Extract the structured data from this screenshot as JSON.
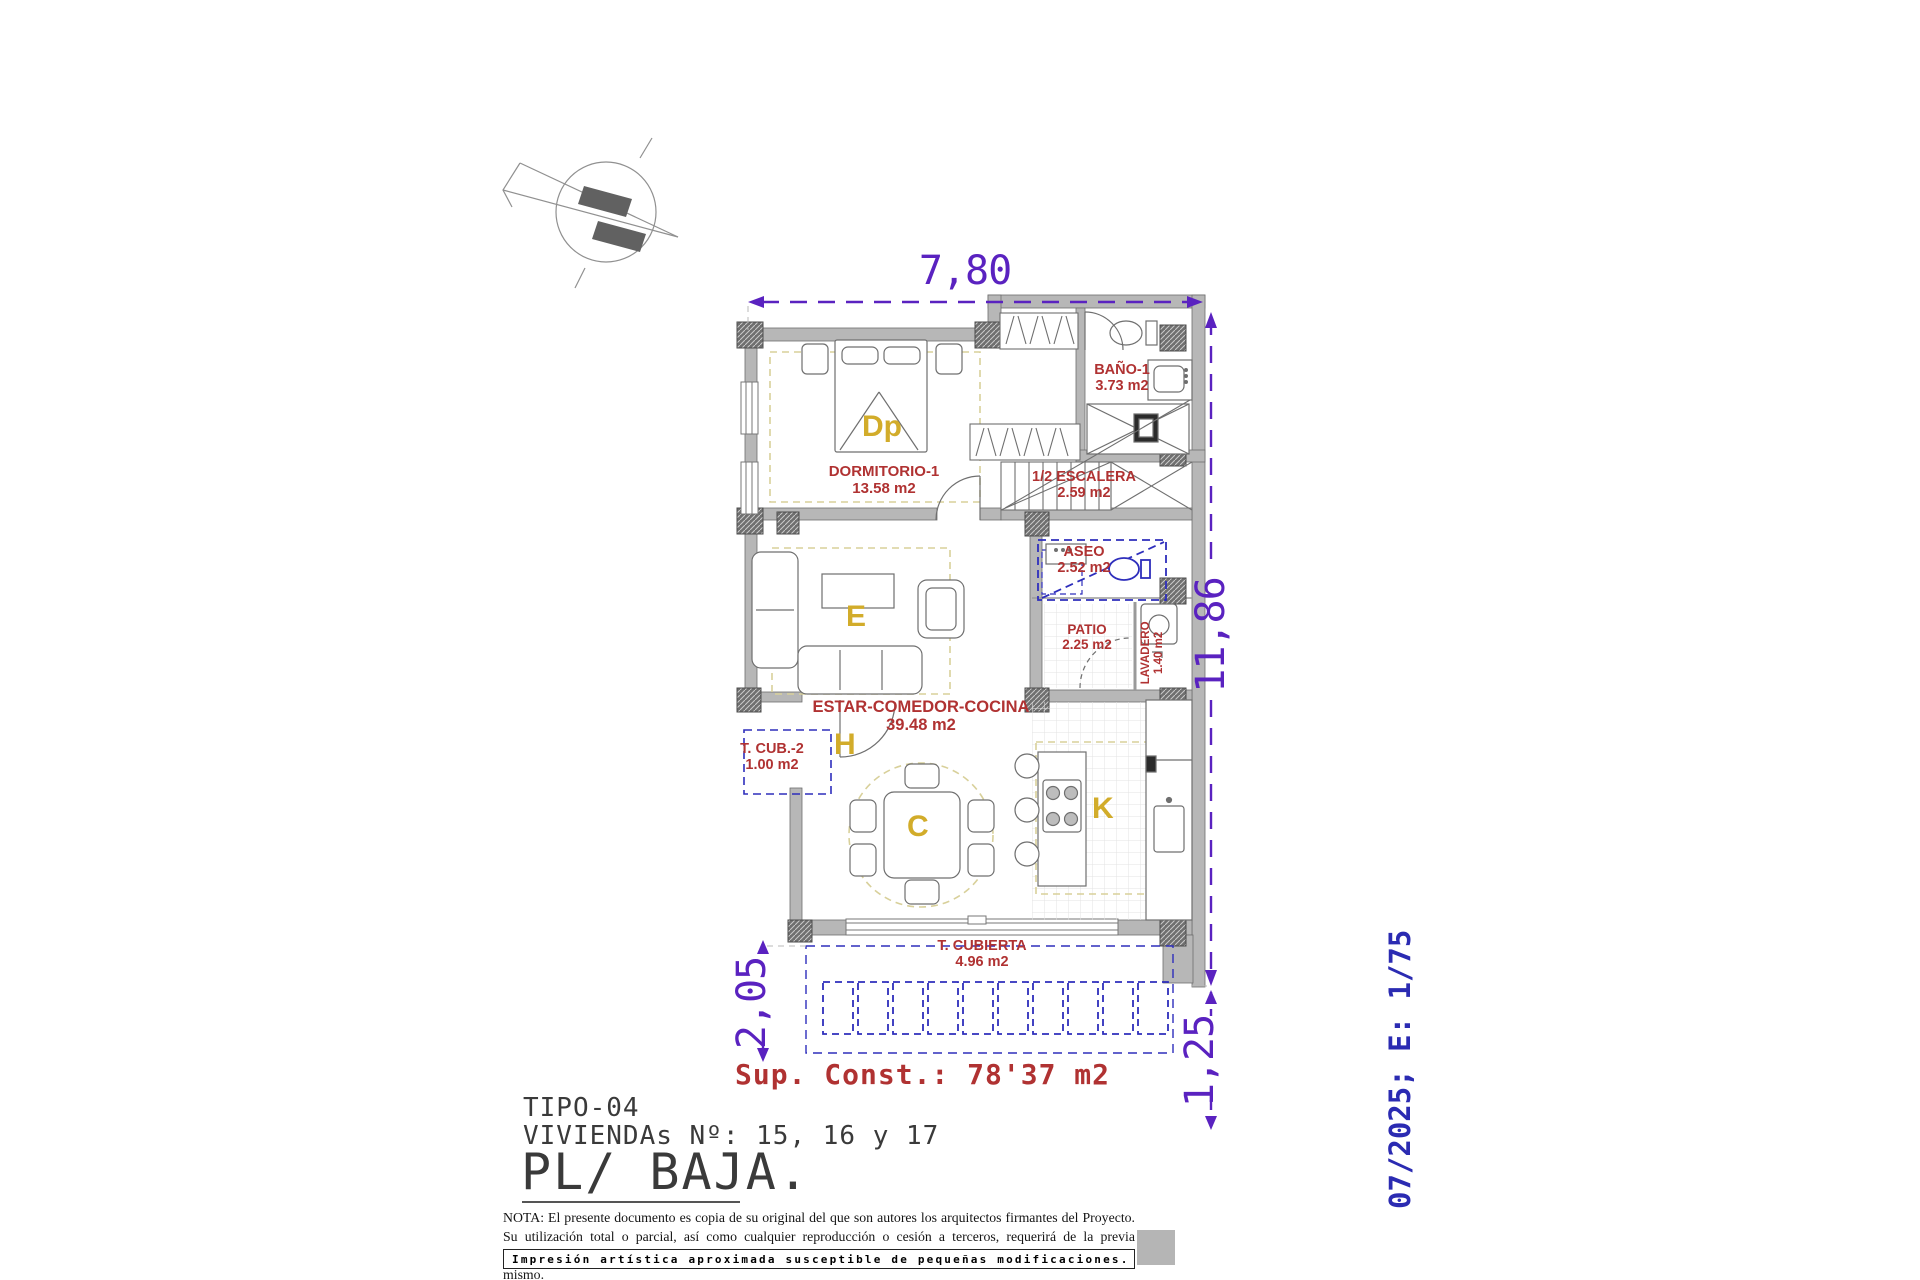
{
  "dimensions": {
    "top": "7,80",
    "right": "11,86",
    "bottom_left": "2,05",
    "bottom_right": "1,25"
  },
  "rooms": {
    "dormitorio": {
      "name": "DORMITORIO-1",
      "area": "13.58 m2",
      "letter": "Dp"
    },
    "bano": {
      "name": "BAÑO-1",
      "area": "3.73 m2"
    },
    "escalera": {
      "name": "1/2 ESCALERA",
      "area": "2.59 m2"
    },
    "aseo": {
      "name": "ASEO",
      "area": "2.52 m2"
    },
    "patio": {
      "name": "PATIO",
      "area": "2.25 m2"
    },
    "lavadero": {
      "name": "LAVADERO",
      "area": "1.40 m2"
    },
    "estar": {
      "name": "ESTAR-COMEDOR-COCINA",
      "area": "39.48 m2",
      "letter_estar": "E",
      "letter_hall": "H",
      "letter_comedor": "C",
      "letter_cocina": "K"
    },
    "tcub2": {
      "name": "T. CUB.-2",
      "area": "1.00 m2"
    },
    "tcubierta": {
      "name": "T. CUBIERTA",
      "area": "4.96 m2"
    }
  },
  "summary": {
    "sup_const": "Sup. Const.: 78'37 m2"
  },
  "title_block": {
    "tipo": "TIPO-04",
    "viviendas": "VIVIENDAs Nº: 15, 16 y 17",
    "planta": "PL/ BAJA."
  },
  "revision": {
    "date_scale": "07/2025; E: 1/75"
  },
  "legal": {
    "nota": "NOTA: El presente documento es copia de su original del que son autores los arquitectos firmantes del Proyecto. Su utilización total o parcial, así como cualquier reproducción o cesión a terceros, requerirá de la previa autorización expresa de sus autores, quedando en todo caso prohibida cualquier modificación unilateral del mismo.",
    "footer": "Impresión artística aproximada susceptible de pequeñas modificaciones."
  },
  "colors": {
    "dimension_purple": "#5a22c0",
    "room_label_red": "#b03232",
    "room_letter_yellow": "#d2ac2a",
    "plan_blue": "#2e2ebc",
    "revision_blue": "#2b2bb2",
    "wall_gray": "#b7b7b7"
  }
}
